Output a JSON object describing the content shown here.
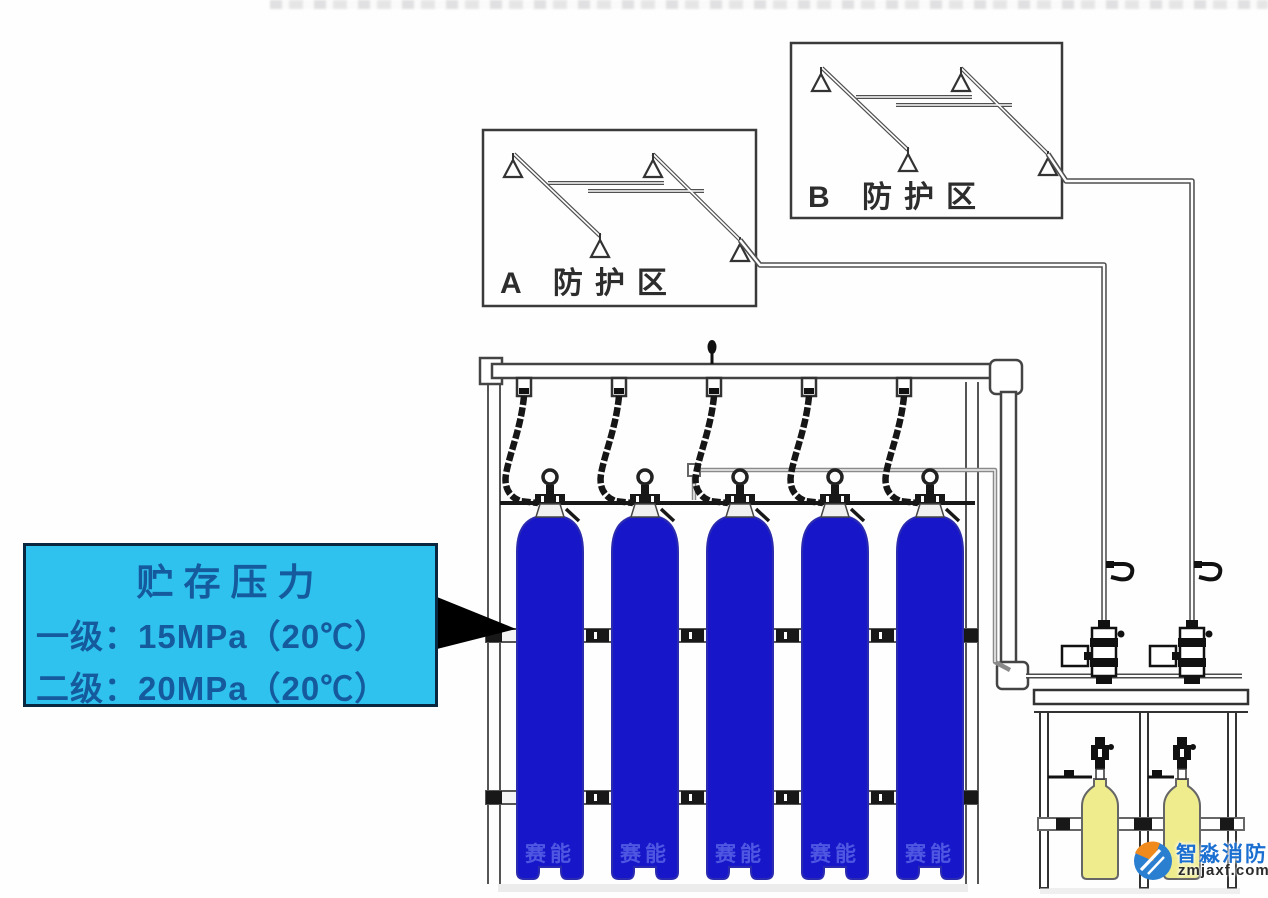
{
  "canvas": {
    "width": 1268,
    "height": 898,
    "background": "#fffefe"
  },
  "zones": {
    "a": {
      "label": "A 防护区",
      "nozzle_count": 4
    },
    "b": {
      "label": "B 防护区",
      "nozzle_count": 4
    }
  },
  "callout": {
    "title": "贮存压力",
    "line1": "一级：15MPa（20℃）",
    "line2": "二级：20MPa（20℃）"
  },
  "storage_cylinders": {
    "count": 5,
    "watermark": "赛能"
  },
  "starter_cylinders": {
    "count": 2
  },
  "logo": {
    "brand": "智淼消防",
    "site": "zmjaxf.com"
  },
  "colors": {
    "cylinder_blue": "#1717c9",
    "cylinder_outline": "#2b2bb0",
    "starter_yellow": "#efec8e",
    "callout_bg": "#2fc2ee",
    "callout_text": "#155a9c",
    "callout_border": "#0a2740",
    "pipe_dark": "#4a4a4a",
    "pilot_gray": "#8a8a8a",
    "logo_blue": "#1b6fd1",
    "logo_orange": "#f08a1d"
  }
}
